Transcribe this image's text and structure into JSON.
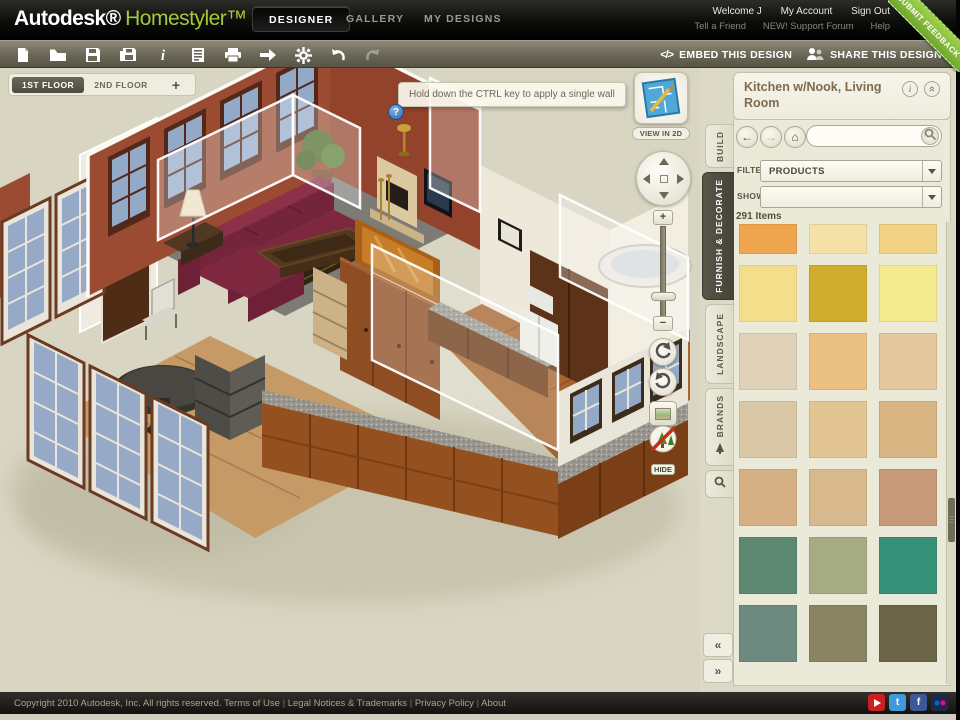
{
  "header": {
    "logo": {
      "autodesk": "Autodesk®",
      "homestyler": "Homestyler™",
      "beta": "BETA"
    },
    "nav": [
      "DESIGNER",
      "GALLERY",
      "MY DESIGNS"
    ],
    "active_nav": "DESIGNER",
    "user_links": [
      "Welcome J",
      "My Account",
      "Sign Out"
    ],
    "secondary_links": [
      "Tell a Friend",
      "NEW! Support Forum",
      "Help"
    ],
    "feedback_ribbon": "SUBMIT FEEDBACK"
  },
  "toolbar": {
    "icons": [
      "new-document",
      "open",
      "save",
      "save-as",
      "info",
      "notes",
      "print",
      "export",
      "settings-gear",
      "undo",
      "redo"
    ],
    "embed_glyph": "</>",
    "embed_label": "EMBED THIS DESIGN",
    "share_label": "SHARE THIS DESIGN"
  },
  "canvas": {
    "floor_tabs": [
      "1ST FLOOR",
      "2ND FLOOR"
    ],
    "active_floor": "1ST FLOOR",
    "add_floor_label": "+",
    "tooltip": "Hold down the CTRL key to apply a single wall",
    "help_glyph": "?",
    "view_in_2d_label": "VIEW IN 2D",
    "zoom_in_glyph": "+",
    "zoom_out_glyph": "−",
    "hide_label": "HIDE",
    "controls": [
      "pan-pad",
      "zoom-slider",
      "rotate-ccw",
      "rotate-cw",
      "snapshot",
      "hide-landscape"
    ]
  },
  "panel": {
    "title": "Kitchen w/Nook, Living Room",
    "info_glyph": "i",
    "collapse_glyph": "»",
    "search_placeholder": "",
    "filter_label": "FILTER:",
    "filter_value": "PRODUCTS",
    "show_label": "SHOW:",
    "show_value": "",
    "items_count": "291 Items",
    "tabs": [
      "BUILD",
      "FURNISH & DECORATE",
      "LANDSCAPE",
      "BRANDS"
    ],
    "active_tab": "FURNISH & DECORATE",
    "collapse_left": "«",
    "collapse_right": "»",
    "swatches": [
      "#EFA54E",
      "#F5E1A8",
      "#F1D284",
      "#F5DE8B",
      "#CFAE2D",
      "#F4EA8F",
      "#DFD1B7",
      "#EAC085",
      "#E4C79D",
      "#DAC7A5",
      "#E2C593",
      "#D8B583",
      "#D5B085",
      "#D7B98D",
      "#C69A78",
      "#5D8972",
      "#A5AC83",
      "#379179",
      "#6E8980",
      "#898463",
      "#6B6446"
    ]
  },
  "footer": {
    "copyright": "Copyright 2010 Autodesk, Inc. All rights reserved.",
    "links": [
      "Terms of Use",
      "Legal Notices & Trademarks",
      "Privacy Policy",
      "About"
    ],
    "social": [
      "youtube",
      "twitter",
      "facebook",
      "flickr"
    ]
  },
  "colors": {
    "accent_green": "#A3C93A",
    "ribbon_green": "#8CC63E",
    "panel_bg": "#EBE9D8",
    "canvas_bg": "#D8D5C2"
  }
}
